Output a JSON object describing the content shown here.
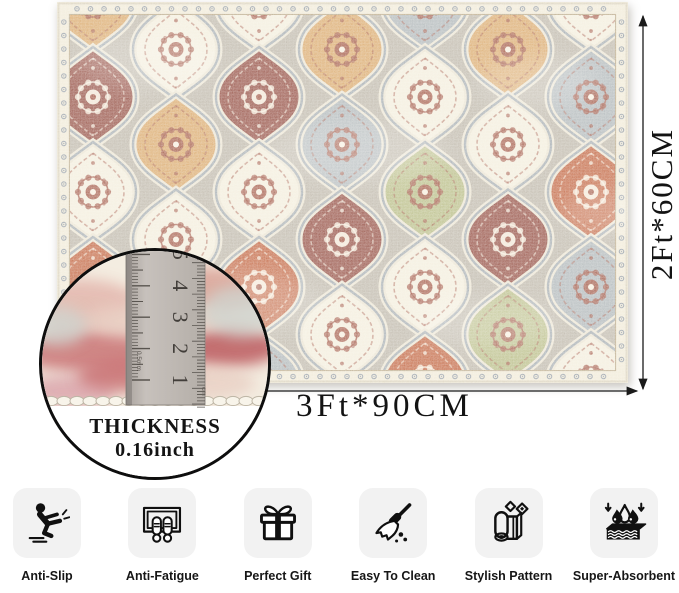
{
  "dimensions": {
    "width_label": "3Ft*90CM",
    "height_label": "2Ft*60CM"
  },
  "thickness_inset": {
    "title": "THICKNESS",
    "value": "0.16inch",
    "ruler_numbers": [
      "1",
      "2",
      "3",
      "4",
      "5"
    ],
    "ruler_small_left": "0.5mm",
    "ruler_small_right": "cm",
    "blur_colors": [
      "#e2b3aa",
      "#d89d92",
      "#c76d70",
      "#b85156",
      "#e8cfc3",
      "#d9a0a8",
      "#cfd3cd"
    ]
  },
  "rug": {
    "field": "#b9b2a5",
    "border_base": "#efe8d5",
    "border_motif_red": "#a04b3a",
    "border_motif_gray": "#8d96a0",
    "border_line": "#b3a17f",
    "lattice_halo": "#e9e2d0",
    "lattice_line": "#96a0a7",
    "motif_dark": "#9a4a38",
    "motif_light": "#f6eddd",
    "palette": {
      "rust": "#bd5a35",
      "brick": "#8c4136",
      "cream": "#f2ecdb",
      "sand": "#d7a261",
      "sage": "#b2b77d",
      "slate": "#a9b1b5"
    },
    "tiles": [
      [
        "sand",
        "brick",
        "cream",
        "rust",
        "slate",
        "cream"
      ],
      [
        "rust",
        "cream",
        "sand",
        "cream",
        "brick",
        "sage"
      ],
      [
        "cream",
        "brick",
        "cream",
        "rust",
        "slate",
        "cream"
      ],
      [
        "brick",
        "sand",
        "slate",
        "brick",
        "cream",
        "rust"
      ],
      [
        "slate",
        "cream",
        "sage",
        "cream",
        "rust",
        "cream"
      ],
      [
        "brick",
        "sand",
        "cream",
        "brick",
        "sage",
        "slate"
      ],
      [
        "cream",
        "slate",
        "rust",
        "slate",
        "cream",
        "brick"
      ],
      [
        "rust",
        "cream",
        "brick",
        "sand",
        "rust",
        "cream"
      ]
    ]
  },
  "features": [
    {
      "name": "anti-slip",
      "label": "Anti-Slip"
    },
    {
      "name": "anti-fatigue",
      "label": "Anti-Fatigue"
    },
    {
      "name": "perfect-gift",
      "label": "Perfect Gift"
    },
    {
      "name": "easy-to-clean",
      "label": "Easy To Clean"
    },
    {
      "name": "stylish-pattern",
      "label": "Stylish Pattern"
    },
    {
      "name": "super-absorbent",
      "label": "Super-Absorbent"
    }
  ]
}
